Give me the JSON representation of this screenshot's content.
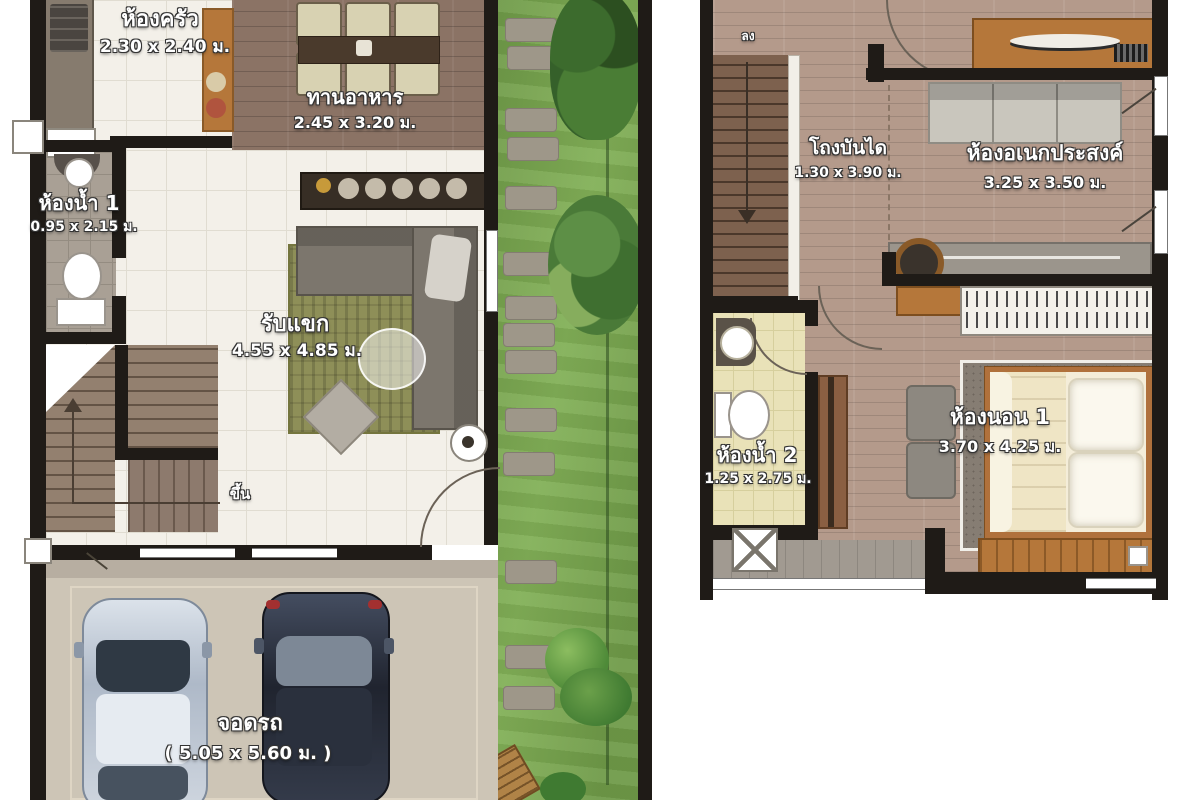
{
  "document": {
    "type": "townhouse-floor-plan",
    "floors": 2
  },
  "floor1": {
    "kitchen": {
      "name": "ห้องครัว",
      "dims": "2.30 x 2.40 ม."
    },
    "dining": {
      "name": "ทานอาหาร",
      "dims": "2.45 x 3.20 ม."
    },
    "bath1": {
      "name": "ห้องน้ำ 1",
      "dims": "0.95 x 2.15 ม."
    },
    "living": {
      "name": "รับแขก",
      "dims": "4.55 x 4.85 ม."
    },
    "parking": {
      "name": "จอดรถ",
      "dims": "( 5.05 x 5.60 ม. )"
    },
    "stairs_up_label": "ขึ้น"
  },
  "floor2": {
    "stair_hall": {
      "name": "โถงบันได",
      "dims": "1.30 x 3.90 ม."
    },
    "multipurpose": {
      "name": "ห้องอเนกประสงค์",
      "dims": "3.25 x 3.50 ม."
    },
    "bath2": {
      "name": "ห้องน้ำ 2",
      "dims": "1.25 x 2.75 ม."
    },
    "bedroom1": {
      "name": "ห้องนอน 1",
      "dims": "3.70 x 4.25 ม."
    },
    "stairs_down_label": "ลง"
  },
  "colors": {
    "wall": "#1f1b17",
    "tile_floor": "#f3f0e9",
    "wood_floor_first": "#8b7365",
    "wood_floor_second": "#b49a8b",
    "bath1_tile": "#a9a095",
    "bath2_tile": "#e9e2b8",
    "grass": "#74a04b",
    "parking_floor": "#cdc5b6",
    "rug_living": "#8e8f58",
    "car_light": "#c3cdd9",
    "car_dark": "#2e3442",
    "cabinet_wood": "#b5773a"
  }
}
